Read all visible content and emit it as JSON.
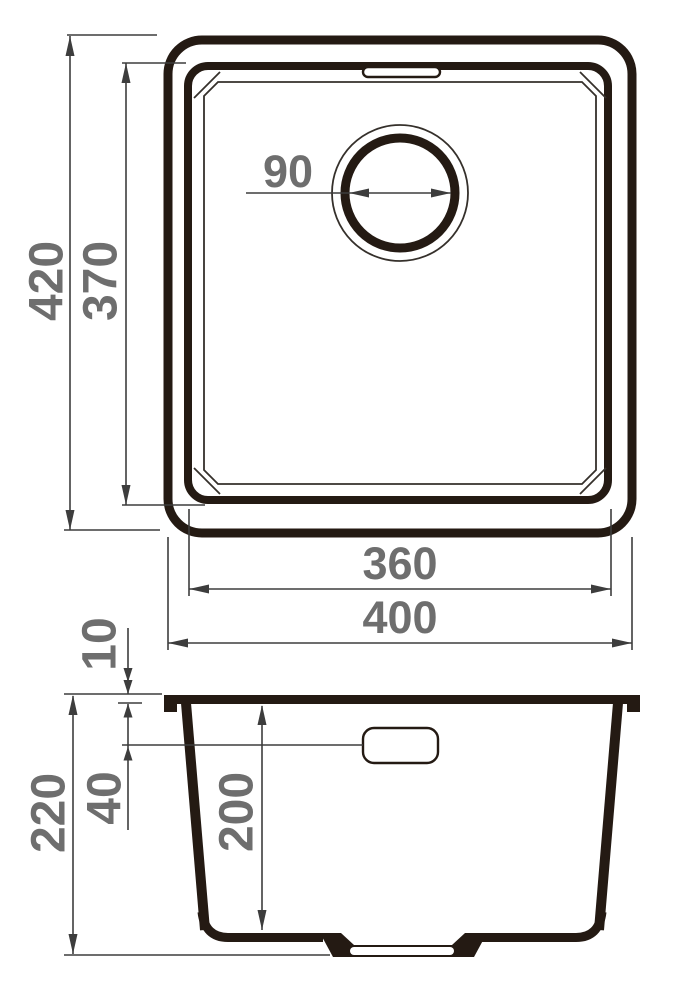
{
  "title": "Kitchen sink dimensional drawing",
  "views": {
    "top": {
      "name": "top view (plan)"
    },
    "side": {
      "name": "side view (section)"
    }
  },
  "dimensions": {
    "overall_height": {
      "value": "420"
    },
    "bowl_height": {
      "value": "370"
    },
    "drain_diameter": {
      "value": "90"
    },
    "bowl_width": {
      "value": "360"
    },
    "overall_width": {
      "value": "400"
    },
    "rim_thickness": {
      "value": "10"
    },
    "overflow_offset": {
      "value": "40"
    },
    "overall_depth": {
      "value": "220"
    },
    "bowl_depth": {
      "value": "200"
    }
  },
  "colors": {
    "outline": "#241a13",
    "dimension_line": "#3d3d3d",
    "dimension_text": "#6e6e6e",
    "background": "#ffffff"
  }
}
